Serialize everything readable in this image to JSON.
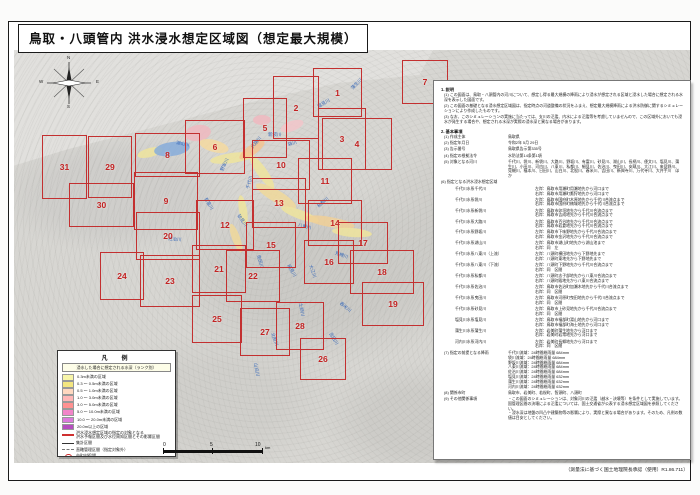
{
  "title": "鳥取・八頭管内 洪水浸水想定区域図（想定最大規模）",
  "footer_credit": "（測量法に基づく国土地理院長承認（使用）R1.86.711）",
  "compass": {
    "n": "N",
    "e": "E",
    "s": "S",
    "w": "W"
  },
  "scale_bar": {
    "ticks": [
      "0",
      "5",
      "10"
    ],
    "unit": "km"
  },
  "colors": {
    "sheet_frame": "#c33030",
    "sheet_number": "#c32222",
    "river_label": "#3a6ab8",
    "lake": "#86abdb",
    "sea": "#e1e0dd",
    "land": "#d7d6d2"
  },
  "map": {
    "sheets": [
      {
        "n": "1",
        "x": 313,
        "y": 68,
        "w": 47,
        "h": 47
      },
      {
        "n": "2",
        "x": 273,
        "y": 76,
        "w": 44,
        "h": 61
      },
      {
        "n": "3",
        "x": 318,
        "y": 108,
        "w": 46,
        "h": 60
      },
      {
        "n": "4",
        "x": 322,
        "y": 118,
        "w": 68,
        "h": 50
      },
      {
        "n": "5",
        "x": 243,
        "y": 98,
        "w": 42,
        "h": 58
      },
      {
        "n": "6",
        "x": 185,
        "y": 120,
        "w": 58,
        "h": 52
      },
      {
        "n": "7",
        "x": 402,
        "y": 60,
        "w": 44,
        "h": 42
      },
      {
        "n": "8",
        "x": 135,
        "y": 133,
        "w": 63,
        "h": 42
      },
      {
        "n": "9",
        "x": 134,
        "y": 172,
        "w": 62,
        "h": 56
      },
      {
        "n": "10",
        "x": 252,
        "y": 140,
        "w": 56,
        "h": 48
      },
      {
        "n": "11",
        "x": 298,
        "y": 158,
        "w": 52,
        "h": 44
      },
      {
        "n": "12",
        "x": 196,
        "y": 200,
        "w": 56,
        "h": 48
      },
      {
        "n": "13",
        "x": 252,
        "y": 178,
        "w": 52,
        "h": 48
      },
      {
        "n": "14",
        "x": 308,
        "y": 200,
        "w": 52,
        "h": 44
      },
      {
        "n": "15",
        "x": 246,
        "y": 222,
        "w": 48,
        "h": 44
      },
      {
        "n": "16",
        "x": 304,
        "y": 240,
        "w": 48,
        "h": 42
      },
      {
        "n": "17",
        "x": 338,
        "y": 222,
        "w": 48,
        "h": 40
      },
      {
        "n": "18",
        "x": 350,
        "y": 250,
        "w": 62,
        "h": 42
      },
      {
        "n": "19",
        "x": 362,
        "y": 282,
        "w": 60,
        "h": 42
      },
      {
        "n": "20",
        "x": 136,
        "y": 212,
        "w": 62,
        "h": 46
      },
      {
        "n": "21",
        "x": 192,
        "y": 245,
        "w": 52,
        "h": 46
      },
      {
        "n": "22",
        "x": 226,
        "y": 250,
        "w": 52,
        "h": 50
      },
      {
        "n": "23",
        "x": 140,
        "y": 255,
        "w": 58,
        "h": 50
      },
      {
        "n": "24",
        "x": 100,
        "y": 252,
        "w": 42,
        "h": 46
      },
      {
        "n": "25",
        "x": 192,
        "y": 295,
        "w": 48,
        "h": 46
      },
      {
        "n": "26",
        "x": 300,
        "y": 338,
        "w": 44,
        "h": 40
      },
      {
        "n": "27",
        "x": 240,
        "y": 308,
        "w": 48,
        "h": 46
      },
      {
        "n": "28",
        "x": 276,
        "y": 302,
        "w": 46,
        "h": 46
      },
      {
        "n": "29",
        "x": 88,
        "y": 136,
        "w": 42,
        "h": 60
      },
      {
        "n": "30",
        "x": 69,
        "y": 183,
        "w": 63,
        "h": 42
      },
      {
        "n": "31",
        "x": 42,
        "y": 135,
        "w": 43,
        "h": 62
      }
    ],
    "river_labels": [
      {
        "t": "千代川",
        "x": 248,
        "y": 186,
        "r": -75
      },
      {
        "t": "袋川",
        "x": 288,
        "y": 142,
        "r": -15
      },
      {
        "t": "新袋川",
        "x": 268,
        "y": 132,
        "r": 0
      },
      {
        "t": "大路川",
        "x": 252,
        "y": 145,
        "r": -50
      },
      {
        "t": "野坂川",
        "x": 222,
        "y": 168,
        "r": -65
      },
      {
        "t": "湖山川",
        "x": 176,
        "y": 140,
        "r": 10
      },
      {
        "t": "塩見川",
        "x": 318,
        "y": 104,
        "r": -30
      },
      {
        "t": "蒲生川",
        "x": 352,
        "y": 86,
        "r": -45
      },
      {
        "t": "八東川",
        "x": 298,
        "y": 222,
        "r": 15
      },
      {
        "t": "私都川",
        "x": 318,
        "y": 204,
        "r": -40
      },
      {
        "t": "佐治川",
        "x": 168,
        "y": 236,
        "r": 5
      },
      {
        "t": "曳田川",
        "x": 258,
        "y": 252,
        "r": 75
      },
      {
        "t": "細見川",
        "x": 288,
        "y": 262,
        "r": 60
      },
      {
        "t": "大江川",
        "x": 310,
        "y": 262,
        "r": 70
      },
      {
        "t": "見槻川",
        "x": 335,
        "y": 250,
        "r": 20
      },
      {
        "t": "土師川",
        "x": 300,
        "y": 300,
        "r": 80
      },
      {
        "t": "北股川",
        "x": 272,
        "y": 330,
        "r": 70
      },
      {
        "t": "山白川",
        "x": 255,
        "y": 360,
        "r": 80
      },
      {
        "t": "舂米川",
        "x": 340,
        "y": 300,
        "r": 40
      },
      {
        "t": "吉田川",
        "x": 330,
        "y": 330,
        "r": 60
      },
      {
        "t": "砂見川",
        "x": 238,
        "y": 212,
        "r": 55
      },
      {
        "t": "有富川",
        "x": 205,
        "y": 195,
        "r": 60
      }
    ],
    "flood_patches": [
      {
        "x": 198,
        "y": 133,
        "w": 26,
        "h": 16,
        "c": "#f0b9c0",
        "r": -10
      },
      {
        "x": 262,
        "y": 120,
        "w": 18,
        "h": 10,
        "c": "#f0b9c0",
        "r": 0
      },
      {
        "x": 292,
        "y": 126,
        "w": 24,
        "h": 10,
        "c": "#f2c6ca",
        "r": -20
      },
      {
        "x": 214,
        "y": 146,
        "w": 30,
        "h": 12,
        "c": "#f5d9a0",
        "r": 15
      },
      {
        "x": 232,
        "y": 158,
        "w": 44,
        "h": 10,
        "c": "#efe49c",
        "r": -8
      },
      {
        "x": 252,
        "y": 150,
        "w": 30,
        "h": 10,
        "c": "#f3c492",
        "r": -35
      },
      {
        "x": 262,
        "y": 172,
        "w": 40,
        "h": 10,
        "c": "#efe49c",
        "r": 55
      },
      {
        "x": 276,
        "y": 196,
        "w": 46,
        "h": 12,
        "c": "#f0d89a",
        "r": 30
      },
      {
        "x": 300,
        "y": 214,
        "w": 40,
        "h": 9,
        "c": "#efe49c",
        "r": 20
      },
      {
        "x": 330,
        "y": 222,
        "w": 50,
        "h": 10,
        "c": "#f0cf96",
        "r": 10
      },
      {
        "x": 352,
        "y": 232,
        "w": 40,
        "h": 9,
        "c": "#efe49c",
        "r": 5
      },
      {
        "x": 243,
        "y": 210,
        "w": 30,
        "h": 8,
        "c": "#efe49c",
        "r": 80
      },
      {
        "x": 236,
        "y": 238,
        "w": 30,
        "h": 8,
        "c": "#f0d89a",
        "r": 70
      },
      {
        "x": 150,
        "y": 152,
        "w": 26,
        "h": 9,
        "c": "#efe49c",
        "r": -15
      },
      {
        "x": 172,
        "y": 149,
        "w": 36,
        "h": 14,
        "c": "#86abdb",
        "r": -8
      }
    ]
  },
  "legend": {
    "title": "凡　例",
    "subtitle": "浸水した場合に想定される水深（ランク別）",
    "depth_rows": [
      {
        "label": "0.3m未満の区域",
        "color": "#f7f5a9"
      },
      {
        "label": "0.3 〜 0.5m未満の区域",
        "color": "#f4e680"
      },
      {
        "label": "0.5 〜 1.0m未満の区域",
        "color": "#ffd8c0"
      },
      {
        "label": "1.0 〜 3.0m未満の区域",
        "color": "#ffb7b7"
      },
      {
        "label": "3.0 〜 5.0m未満の区域",
        "color": "#ff9191"
      },
      {
        "label": "5.0 〜 10.0m未満の区域",
        "color": "#f285c9"
      },
      {
        "label": "10.0 〜 20.0m未満の区域",
        "color": "#dc7adc"
      },
      {
        "label": "20.0m以上の区域",
        "color": "#b54ebf"
      }
    ],
    "line_rows": [
      {
        "label": "洪水浸水想定区域の指定の対象となる\n洪水予報区間及び水位周知区間とその影響区間",
        "sym": "redline"
      },
      {
        "label": "集計区間",
        "sym": "tickline"
      },
      {
        "label": "直轄管理区間（指定対象外）",
        "sym": "dashline"
      },
      {
        "label": "市町村役場",
        "sym": "circle"
      },
      {
        "label": "図郭範囲",
        "sym": "frame"
      }
    ]
  },
  "notes_panel": {
    "s1_title": "1. 説明",
    "s1_items": [
      "(1) この図面は、鳥取・八頭管内の河川について、想定し得る最大規模の降雨により浸水が想定される区域と浸水した場合に想定される水深を表示した図面です。",
      "(2) この図面の基礎となる浸水想定区域図は、指定時点の河道整備の状況をふまえ、想定最大規模降雨による洪水防御に関するシミュレーションにより作成したものです。",
      "(3) なお、このシミュレーションの実施に当たっては、支川の氾濫、内水による氾濫等を考慮していませんので、この区域外においても浸水が発生する場合や、想定される水深が実際の浸水深と異なる場合があります。"
    ],
    "s2_title": "2. 基本事項",
    "s2_rows_a": [
      {
        "label": "(1) 作成主体",
        "value": "鳥取県"
      },
      {
        "label": "(2) 指定年月日",
        "value": "令和2年 5月 29日"
      },
      {
        "label": "(3) 告示番号",
        "value": "鳥取県告示第335号"
      },
      {
        "label": "(4) 指定の根拠法令",
        "value": "水防法第14条第1項"
      },
      {
        "label": "(5) 対象となる河川",
        "value": "千代川、袋川、新袋川、大路川、野坂川、有富川、砂見川、湖山川、長柄川、倭文川、塩見川、蒲生川、小田川、河内川、八東川、私都川、細見川、佐治川、曳田川、安蔵川、大江川、来見野川、見槻川、福本川、日田川、山白川、北股川、春米川、吉田川、新興寺川、万代寺川、大井手川　ほか"
      }
    ],
    "zones_label": "(6) 指定となる洪水浸水想定区域",
    "zones": [
      {
        "name": "千代川水系千代川",
        "desc": "左岸：鳥取市用瀬町用瀬地先から河口まで\n右岸：鳥取市用瀬町鷹狩地先から河口まで"
      },
      {
        "name": "千代川水系袋川",
        "desc": "左岸：鳥取市国府町木原地先から千代川合流点まで\n右岸：鳥取市国府町楠城地先から千代川合流点まで"
      },
      {
        "name": "千代川水系新袋川",
        "desc": "左岸：鳥取市卯垣地先から千代川合流点まで\n右岸：鳥取市吉成地先から千代川合流点まで"
      },
      {
        "name": "千代川水系大路川",
        "desc": "左岸：鳥取市百谷地先から千代川合流点まで\n右岸：鳥取市岩倉地先から千代川合流点まで"
      },
      {
        "name": "千代川水系野坂川",
        "desc": "左岸：鳥取市下味野地先から千代川合流点まで\n右岸：鳥取市金沢地先から千代川合流点まで"
      },
      {
        "name": "千代川水系湖山川",
        "desc": "左岸：鳥取市湖山町地先から湖山池まで\n右岸：同　左"
      },
      {
        "name": "千代川水系八東川（上流）",
        "desc": "左岸：八頭町横田地先から下野地先まで\n右岸：八頭町東地先から下野地先まで"
      },
      {
        "name": "千代川水系八東川（下流）",
        "desc": "左岸：八頭町下野地先から千代川合流点まで\n右岸：同　区間"
      },
      {
        "name": "千代川水系私都川",
        "desc": "左岸：八頭町志子部地先から八東川合流点まで\n右岸：八頭町殿地先から八東川合流点まで"
      },
      {
        "name": "千代川水系佐治川",
        "desc": "左岸：鳥取市佐治町加瀬木地先から千代川合流点まで\n右岸：同　区間"
      },
      {
        "name": "千代川水系曳田川",
        "desc": "左岸：鳥取市河原町曳田地先から千代川合流点まで\n右岸：同　区間"
      },
      {
        "name": "千代川水系砂見川",
        "desc": "左岸：鳥取市上砂見地先から千代川合流点まで\n右岸：同　区間"
      },
      {
        "name": "塩見川水系塩見川",
        "desc": "左岸：鳥取市福部町湯山地先から河口まで\n右岸：鳥取市福部町海士地先から河口まで"
      },
      {
        "name": "蒲生川水系蒲生川",
        "desc": "左岸：岩美町蒲生地先から河口まで\n右岸：岩美町岩常地先から河口まで"
      },
      {
        "name": "河内川水系河内川",
        "desc": "左岸：岩美町長郷地先から河口まで\n右岸：同　区間"
      }
    ],
    "s2_rows_b": [
      {
        "label": "(7) 指定の前提となる降雨",
        "value": "千代川流域：24時間総雨量 684mm\n袋川流域：24時間総雨量 684mm\n野坂川流域：24時間総雨量 684mm\n八東川流域：24時間総雨量 684mm\n佐治川流域：24時間総雨量 684mm\n塩見川流域：24時間総雨量 632mm\n蒲生川流域：24時間総雨量 632mm\n河内川流域：24時間総雨量 632mm"
      },
      {
        "label": "(8) 関係市町",
        "value": "鳥取市、岩美町、若桜町、智頭町、八頭町"
      },
      {
        "label": "(9) その他関係事項",
        "value": "・この図面のシミュレーションは、対象河川の氾濫（越水・決壊等）を条件として実施しています。国管理区間の決壊による氾濫については、国土交通省が公表する浸水想定区域図を参照してください。\n・浸水深は地盤の凹凸や建築物等の影響により、実際と異なる場合があります。そのため、凡例の数値は目安としてください。"
      }
    ]
  }
}
